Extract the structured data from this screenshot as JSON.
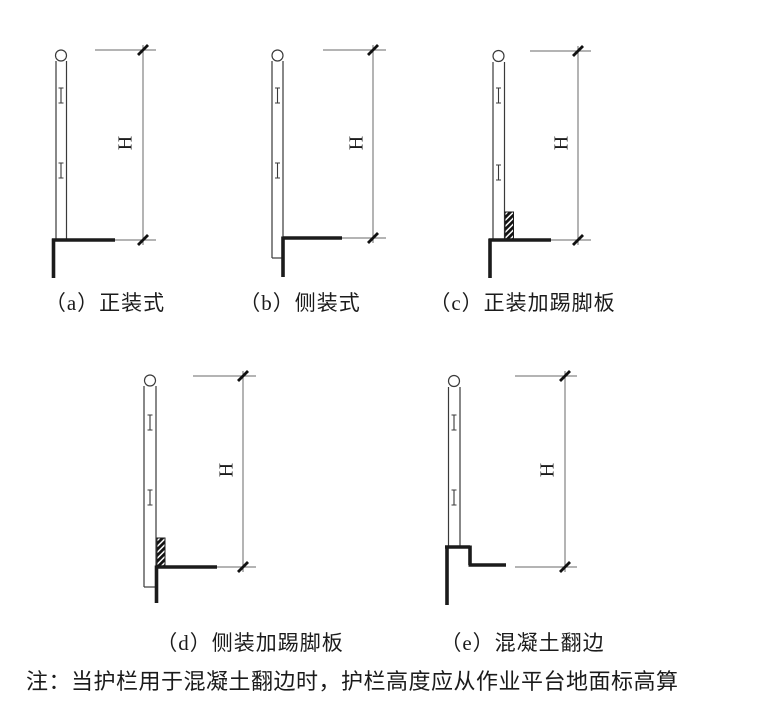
{
  "figures": [
    {
      "id": "a",
      "caption": "（a）正装式"
    },
    {
      "id": "b",
      "caption": "（b）侧装式"
    },
    {
      "id": "c",
      "caption": "（c）正装加踢脚板"
    },
    {
      "id": "d",
      "caption": "（d）侧装加踢脚板"
    },
    {
      "id": "e",
      "caption": "（e）混凝土翻边"
    }
  ],
  "dimension_label": "H",
  "note": "注：当护栏用于混凝土翻边时，护栏高度应从作业平台地面标高算",
  "colors": {
    "line": "#1b1b1b",
    "thin": "#3a3a3a",
    "dim": "#6a6a6a",
    "bg": "#ffffff"
  }
}
